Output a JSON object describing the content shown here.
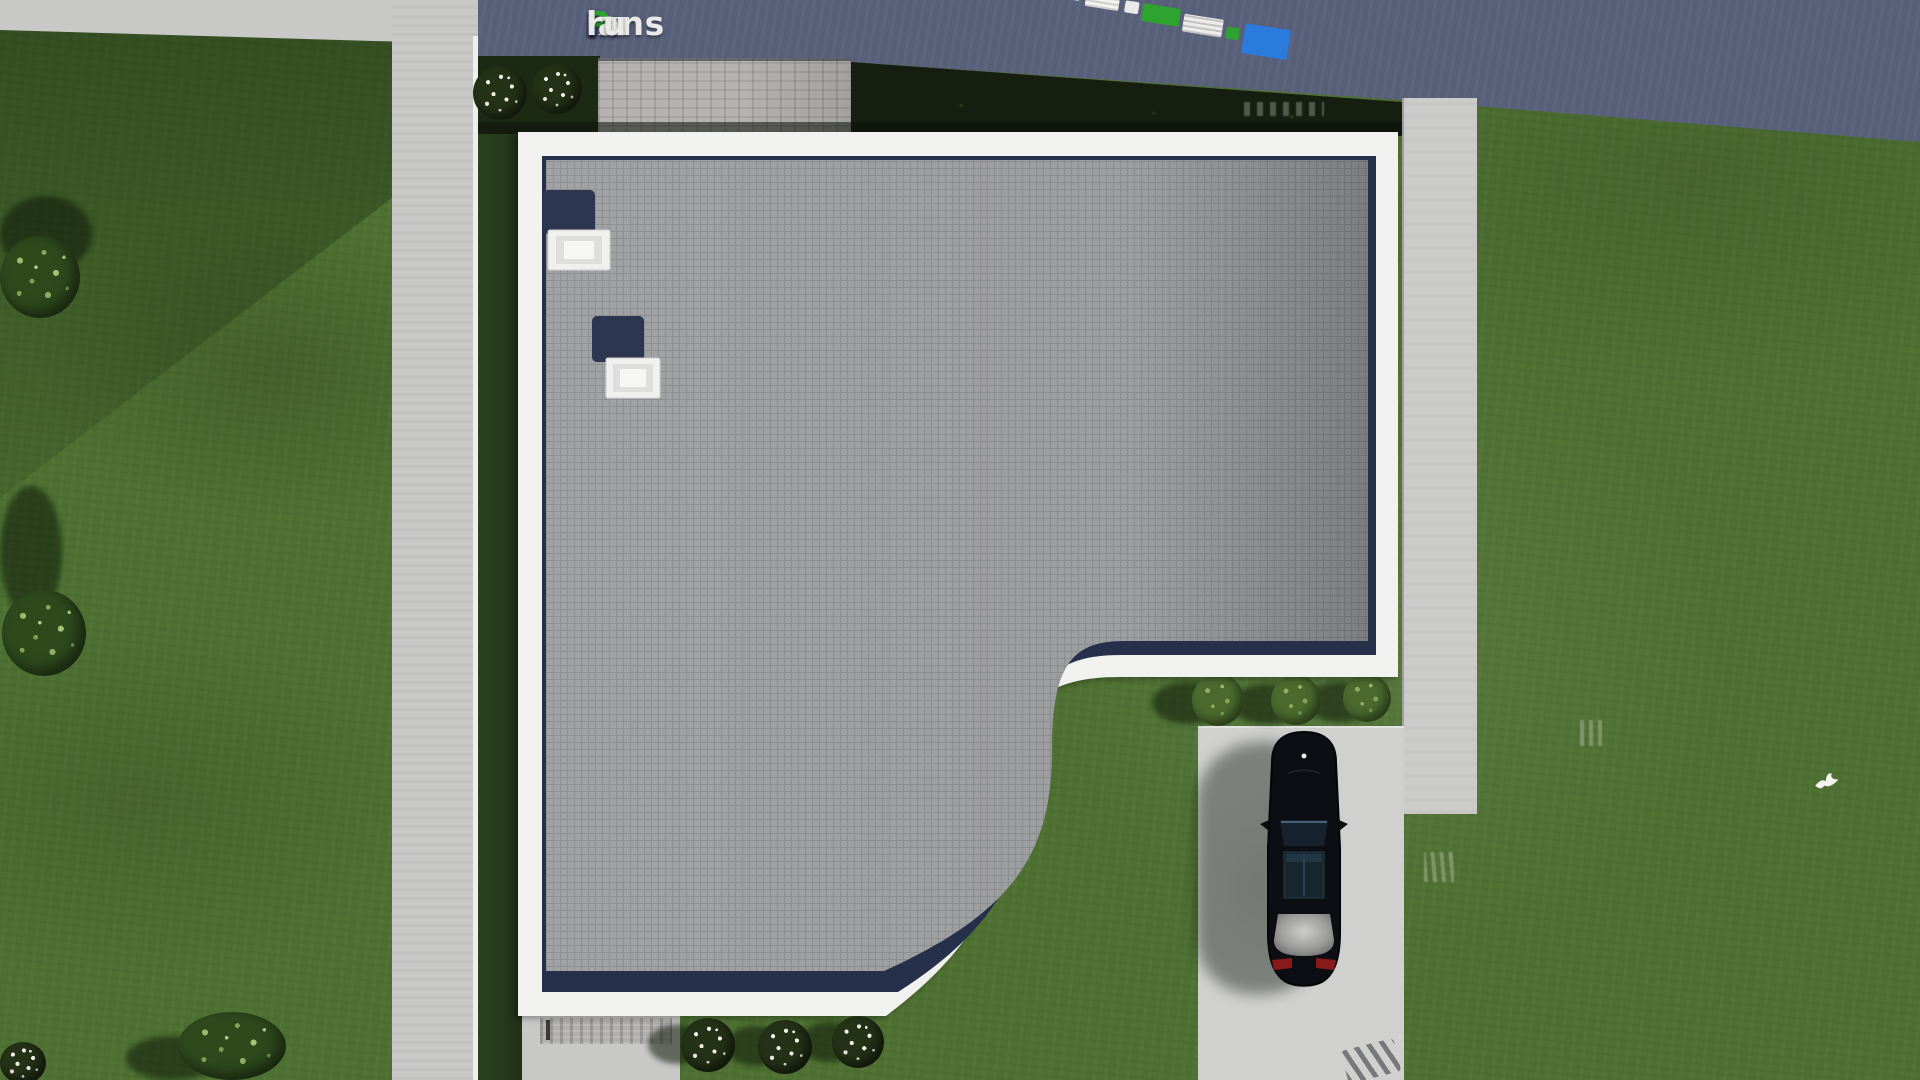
{
  "watermark": {
    "brand": "FixPlans.ru",
    "segments": [
      {
        "text": "F",
        "color": "#2b7bdc"
      },
      {
        "text": "ix",
        "color": "#e9e9e7"
      },
      {
        "text": "P",
        "color": "#2fa32f"
      },
      {
        "text": "lans",
        "color": "#e9e9e7"
      },
      {
        "text": ".",
        "color": "#2b7bdc"
      },
      {
        "text": "ru",
        "color": "#e9e9e7"
      }
    ]
  },
  "scene": {
    "colors": {
      "lawn": "#4e7132",
      "lawn_shadow": "#263d1c",
      "road": "#585f79",
      "sidewalk": "#c8c8c6",
      "paver_apron": "#b4b3b1",
      "hedge": "#151e10",
      "roof_surface": "#a1a2a4",
      "roof_parapet": "#f1f1ef",
      "roof_edge_shadow": "#27304a",
      "skylight_well": "#2d3650",
      "skylight_frame": "#efefed",
      "driveway": "#d0d0ce",
      "path_right": "#cbcbc9",
      "car_body": "#0d1016",
      "car_glass": "#1e3340",
      "car_trunk": "#9b9b99",
      "car_taillight": "#8a1a1a",
      "shrub": "#557a3a",
      "flower_white": "#f2f2ec"
    }
  }
}
